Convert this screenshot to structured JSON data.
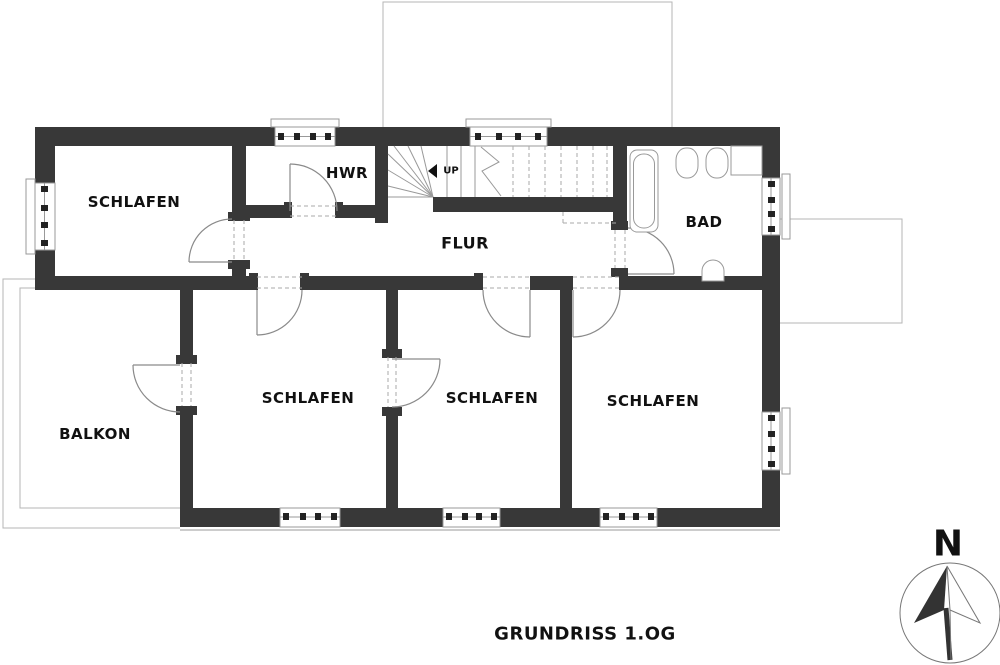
{
  "title": "GRUNDRISS 1.OG",
  "compass": {
    "label": "N"
  },
  "stairs": {
    "up_label": "UP"
  },
  "rooms": {
    "schlafen_nw": {
      "label": "SCHLAFEN"
    },
    "hwr": {
      "label": "HWR"
    },
    "flur": {
      "label": "FLUR"
    },
    "bad": {
      "label": "BAD"
    },
    "balkon": {
      "label": "BALKON"
    },
    "schlafen_sw": {
      "label": "SCHLAFEN"
    },
    "schlafen_s": {
      "label": "SCHLAFEN"
    },
    "schlafen_se": {
      "label": "SCHLAFEN"
    }
  },
  "colors": {
    "wall": "#383838",
    "line": "#999999",
    "text": "#111111",
    "dash": "#aaaaaa",
    "thin": "#b5b5b5"
  }
}
